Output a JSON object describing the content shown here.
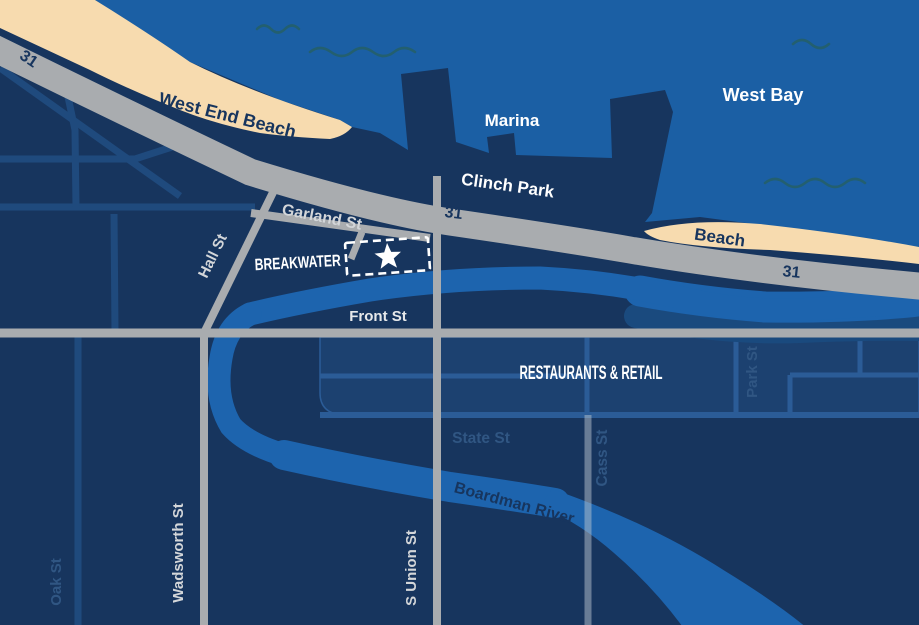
{
  "labels": {
    "west_bay": "West Bay",
    "marina": "Marina",
    "west_end_beach": "West End Beach",
    "clinch_park": "Clinch Park",
    "beach": "Beach",
    "breakwater": "BREAKWATER",
    "restaurants_retail": "RESTAURANTS & RETAIL",
    "boardman_river": "Boardman River"
  },
  "streets": {
    "garland": "Garland St",
    "hall": "Hall St",
    "front": "Front St",
    "s_union": "S Union St",
    "wadsworth": "Wadsworth St",
    "oak": "Oak St",
    "state": "State St",
    "cass": "Cass St",
    "park": "Park St"
  },
  "highway": {
    "route_number": "31"
  },
  "marker": {
    "type": "star",
    "area": "breakwater-site"
  },
  "colors": {
    "background_land": "#17355E",
    "water": "#1B5FA4",
    "sand": "#F7DBAF",
    "river": "#1D64AE",
    "river_shadow": "#1A4A7E",
    "road_gray": "#A9ACAF",
    "minor_street": "#1F4A7D",
    "block_fill": "#1C4170",
    "block_street": "#2B5C97",
    "ghost_label": "#305683",
    "road_label": "#D3D6D9",
    "navy_label": "#17355E",
    "wave": "#235F6F",
    "marker_white": "#FFFFFF"
  }
}
